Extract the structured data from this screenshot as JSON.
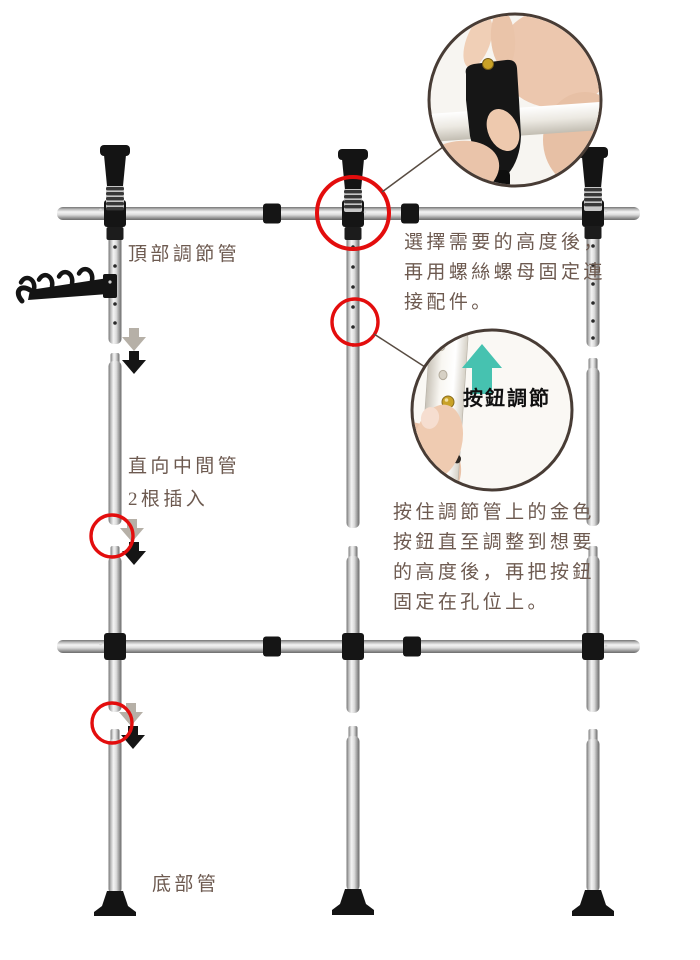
{
  "labels": {
    "top_tube": "頂部調節管",
    "vertical_middle_tube": "直向中間管",
    "vertical_middle_tube_note": "2根插入",
    "bottom_tube": "底部管",
    "button_adjust_badge": "按鈕調節"
  },
  "instructions": {
    "screw_fix": [
      "選擇需要的高度後，",
      "再用螺絲螺母固定連",
      "接配件。"
    ],
    "button_adjust": [
      "按住調節管上的金色",
      "按鈕直至調整到想要",
      "的高度後，再把按鈕",
      "固定在孔位上。"
    ]
  },
  "colors": {
    "highlight_red": "#e30d0d",
    "teal": "#46c2b0",
    "text": "#6d5a50",
    "black_part": "#161616",
    "gold": "#c9a227"
  }
}
